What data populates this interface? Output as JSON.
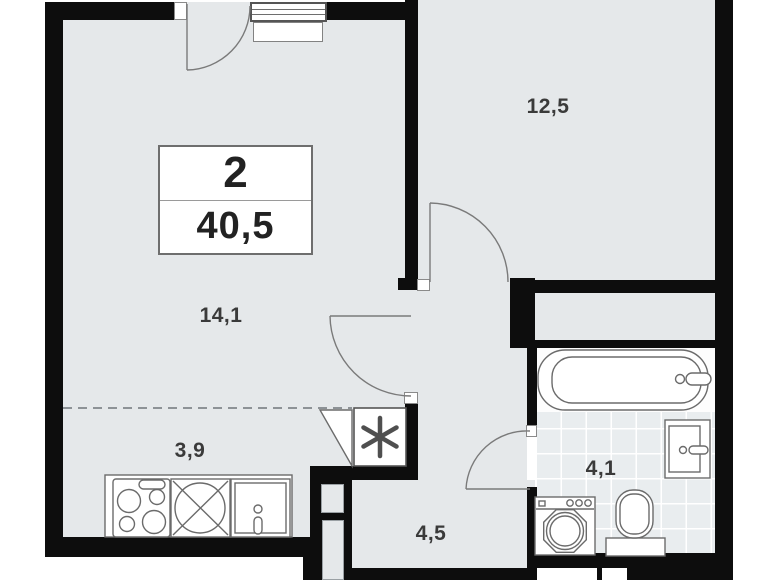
{
  "title": "Apartment floor plan",
  "summary": {
    "rooms_count": "2",
    "total_area": "40,5"
  },
  "rooms": [
    {
      "name": "living-room",
      "area": "14,1"
    },
    {
      "name": "bedroom",
      "area": "12,5"
    },
    {
      "name": "kitchen-niche",
      "area": "3,9"
    },
    {
      "name": "hallway",
      "area": "4,5"
    },
    {
      "name": "bathroom",
      "area": "4,1"
    }
  ],
  "fixtures": [
    "stove",
    "kitchen-sink",
    "kitchen-cabinet",
    "refrigerator",
    "bathtub",
    "washbasin",
    "toilet",
    "washing-machine",
    "balcony-door",
    "window",
    "ventilation-shaft"
  ],
  "refrigerator_symbol": "snowflake-asterisk",
  "colors": {
    "wall": "#0d0d0d",
    "floor": "#e5e8ea",
    "tile_floor": "#e9edef",
    "fixture_line": "#6b6b6b",
    "text": "#3a3a3a",
    "background": "#ffffff"
  }
}
